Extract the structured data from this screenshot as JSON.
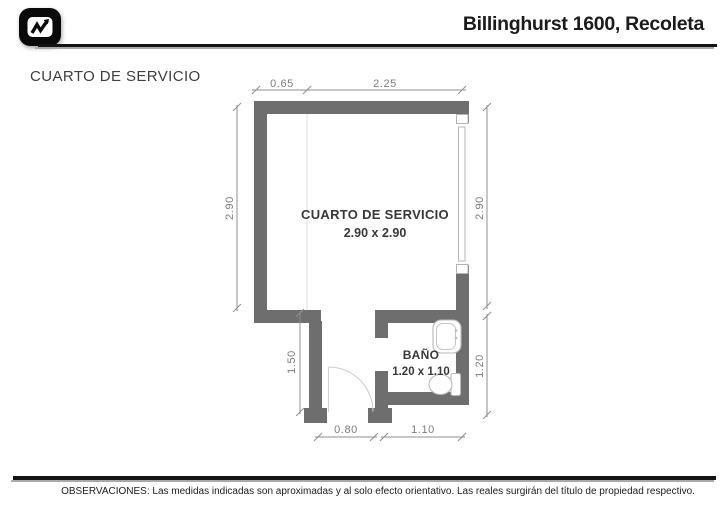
{
  "header": {
    "title": "Billinghurst 1600, Recoleta",
    "logo_icon": "chart-pulse-icon"
  },
  "plan": {
    "page_label": "CUARTO DE SERVICIO",
    "rooms": [
      {
        "name": "CUARTO DE SERVICIO",
        "size": "2.90 x 2.90"
      },
      {
        "name": "BAÑO",
        "size": "1.20 x 1.10"
      }
    ],
    "dimensions": {
      "top": [
        "0.65",
        "2.25"
      ],
      "left": "2.90",
      "right_upper": "2.90",
      "right_lower": "1.20",
      "corridor": "1.50",
      "bottom": [
        "0.80",
        "1.10"
      ]
    },
    "colors": {
      "wall": "#6e6e6e",
      "dimension": "#8f8f8f",
      "fixture_outline": "#b9b9b9",
      "door": "#cfcfcf"
    }
  },
  "footer": {
    "observations": "OBSERVACIONES: Las medidas indicadas son aproximadas y al solo efecto orientativo. Las reales surgirán del título de propiedad respectivo."
  }
}
